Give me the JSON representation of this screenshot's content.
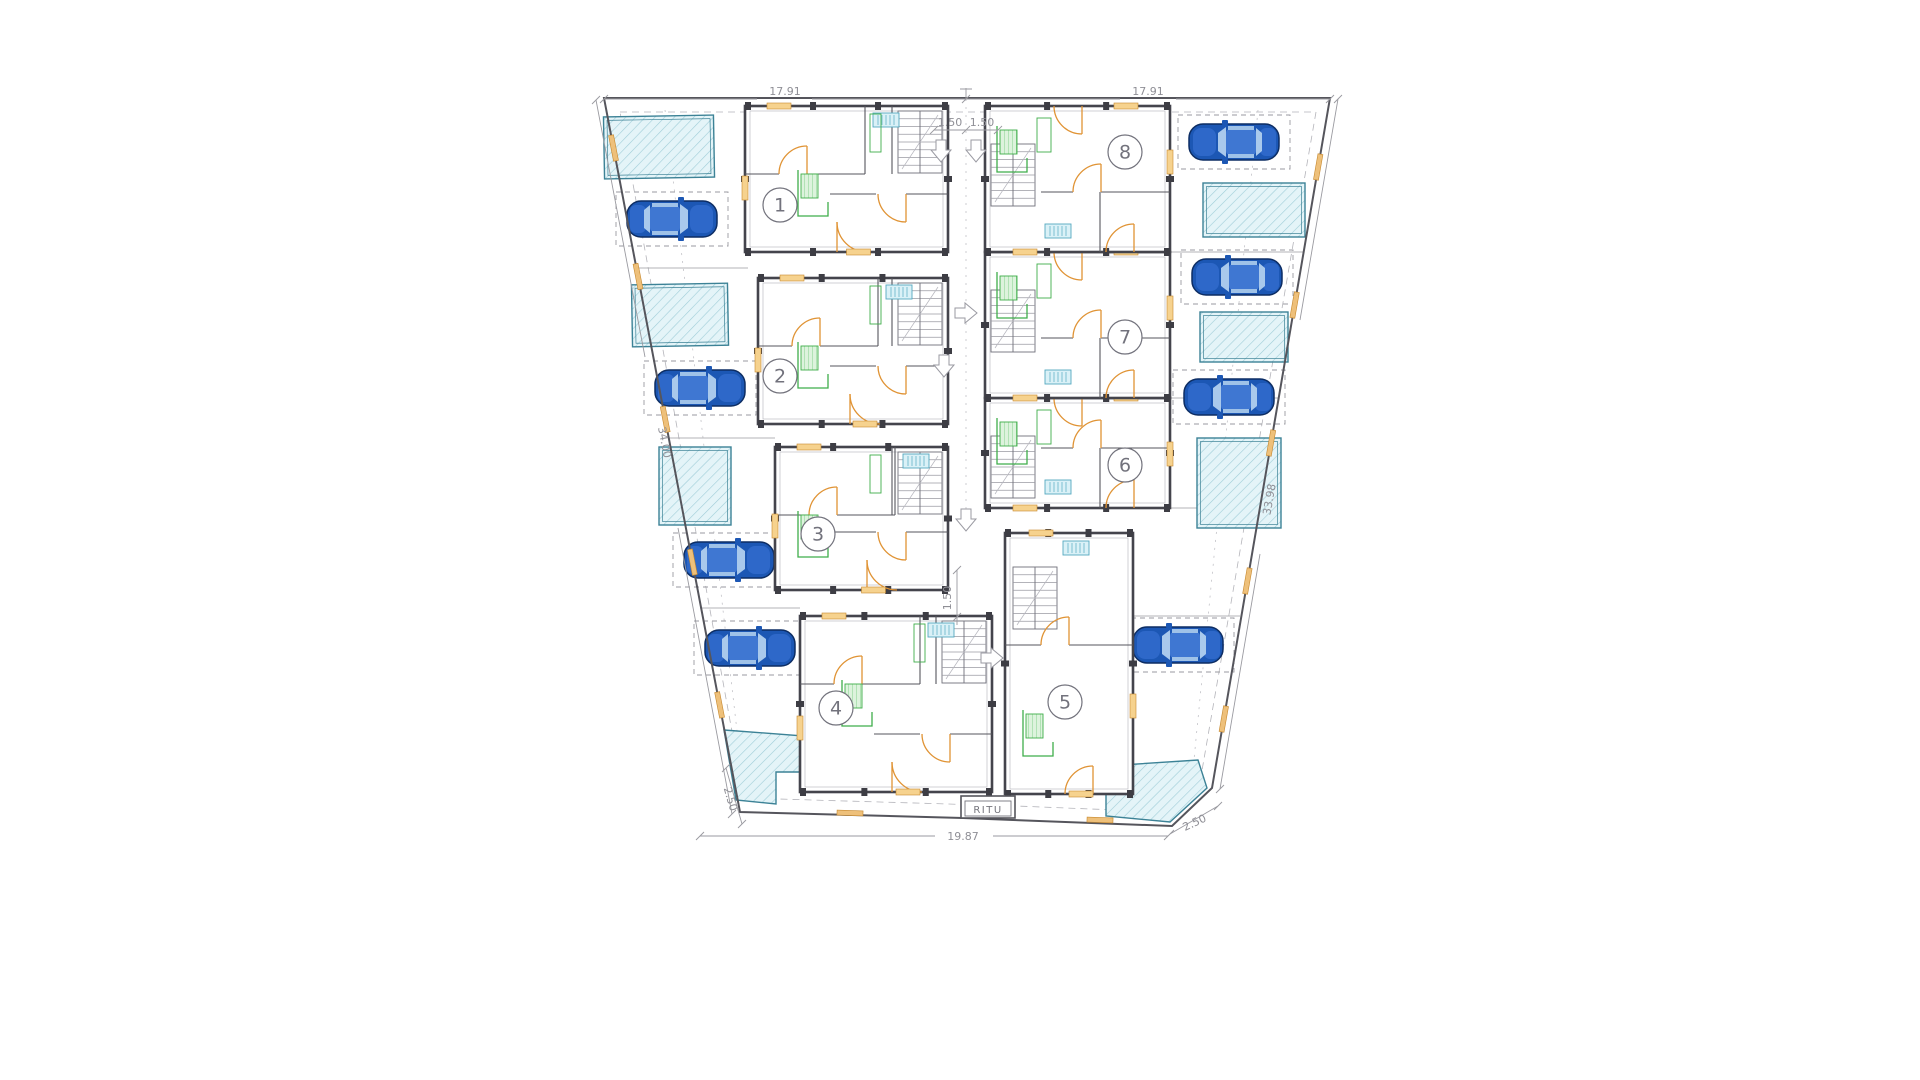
{
  "drawing": {
    "type": "architectural-site-plan",
    "labels": {
      "ritu": "RITU"
    },
    "units": [
      {
        "number": "1",
        "cx": 780,
        "cy": 205
      },
      {
        "number": "2",
        "cx": 780,
        "cy": 376
      },
      {
        "number": "3",
        "cx": 818,
        "cy": 534
      },
      {
        "number": "4",
        "cx": 836,
        "cy": 708
      },
      {
        "number": "5",
        "cx": 1065,
        "cy": 702
      },
      {
        "number": "6",
        "cx": 1125,
        "cy": 465
      },
      {
        "number": "7",
        "cx": 1125,
        "cy": 337
      },
      {
        "number": "8",
        "cx": 1125,
        "cy": 152
      }
    ],
    "buildings": [
      {
        "unit": "1",
        "x": 745,
        "y": 106,
        "w": 203,
        "h": 146,
        "side": "left"
      },
      {
        "unit": "2",
        "x": 758,
        "y": 278,
        "w": 190,
        "h": 146,
        "side": "left"
      },
      {
        "unit": "3",
        "x": 775,
        "y": 447,
        "w": 173,
        "h": 143,
        "side": "left"
      },
      {
        "unit": "4",
        "x": 800,
        "y": 616,
        "w": 192,
        "h": 176,
        "side": "left"
      },
      {
        "unit": "5",
        "x": 1005,
        "y": 533,
        "w": 128,
        "h": 261,
        "side": "center"
      },
      {
        "unit": "6",
        "x": 985,
        "y": 398,
        "w": 185,
        "h": 110,
        "side": "right"
      },
      {
        "unit": "7",
        "x": 985,
        "y": 252,
        "w": 185,
        "h": 146,
        "side": "right"
      },
      {
        "unit": "8",
        "x": 985,
        "y": 106,
        "w": 185,
        "h": 146,
        "side": "right"
      }
    ],
    "cars": [
      {
        "x": 672,
        "y": 219,
        "flip": false
      },
      {
        "x": 700,
        "y": 388,
        "flip": false
      },
      {
        "x": 729,
        "y": 560,
        "flip": false
      },
      {
        "x": 750,
        "y": 648,
        "flip": false
      },
      {
        "x": 1234,
        "y": 142,
        "flip": true
      },
      {
        "x": 1237,
        "y": 277,
        "flip": true
      },
      {
        "x": 1229,
        "y": 397,
        "flip": true
      },
      {
        "x": 1178,
        "y": 645,
        "flip": true
      }
    ],
    "pools": {
      "rects": [
        {
          "x": 604,
          "y": 116,
          "w": 110,
          "h": 62,
          "rot": -1
        },
        {
          "x": 632,
          "y": 284,
          "w": 96,
          "h": 62,
          "rot": -1
        },
        {
          "x": 659,
          "y": 447,
          "w": 72,
          "h": 78,
          "rot": 0
        },
        {
          "x": 1203,
          "y": 183,
          "w": 102,
          "h": 54,
          "rot": 0
        },
        {
          "x": 1200,
          "y": 312,
          "w": 88,
          "h": 50,
          "rot": 0
        },
        {
          "x": 1197,
          "y": 438,
          "w": 84,
          "h": 90,
          "rot": 0
        }
      ],
      "polys": [
        "724,730 804,736 804,772 776,772 776,804 736,800",
        "1106,766 1198,760 1207,788 1170,822 1106,816"
      ]
    },
    "arrows": [
      {
        "x": 941,
        "y": 151,
        "dir": "down"
      },
      {
        "x": 976,
        "y": 151,
        "dir": "down"
      },
      {
        "x": 966,
        "y": 313,
        "dir": "right"
      },
      {
        "x": 944,
        "y": 366,
        "dir": "down"
      },
      {
        "x": 966,
        "y": 520,
        "dir": "down"
      },
      {
        "x": 992,
        "y": 658,
        "dir": "right"
      }
    ],
    "dimensions": [
      {
        "label": "17.91",
        "x": 785,
        "y": 95,
        "rot": 0
      },
      {
        "label": "17.91",
        "x": 1148,
        "y": 95,
        "rot": 0
      },
      {
        "label": "1.50",
        "x": 950,
        "y": 126,
        "rot": 0
      },
      {
        "label": "1.50",
        "x": 982,
        "y": 126,
        "rot": 0
      },
      {
        "label": "34.00",
        "x": 661,
        "y": 443,
        "rot": 79
      },
      {
        "label": "33.98",
        "x": 1273,
        "y": 500,
        "rot": -80
      },
      {
        "label": "1.50",
        "x": 951,
        "y": 598,
        "rot": -90
      },
      {
        "label": "2.50",
        "x": 727,
        "y": 800,
        "rot": 74
      },
      {
        "label": "19.87",
        "x": 963,
        "y": 840,
        "rot": 0
      },
      {
        "label": "2.50",
        "x": 1196,
        "y": 826,
        "rot": -25
      }
    ],
    "site": {
      "outer": "604,98 1330,98 1212,788 1172,826 1013,820 963,818 740,812",
      "setback": "620,112 1316,112 1200,782 1166,812 1016,806 744,798"
    },
    "colors": {
      "wall": "#55555c",
      "dim_line": "#9a9aa0",
      "door_orange": "#e09334",
      "sill_orange": "#f6d28e",
      "kitchen_green": "#3fae4a",
      "pool_fill": "#e4f4f8",
      "pool_line": "#3c8296",
      "radiator_cyan": "#54a8c0",
      "car_body_blue": "#1c57b4",
      "car_glass_blue": "#a9c9ec"
    }
  }
}
